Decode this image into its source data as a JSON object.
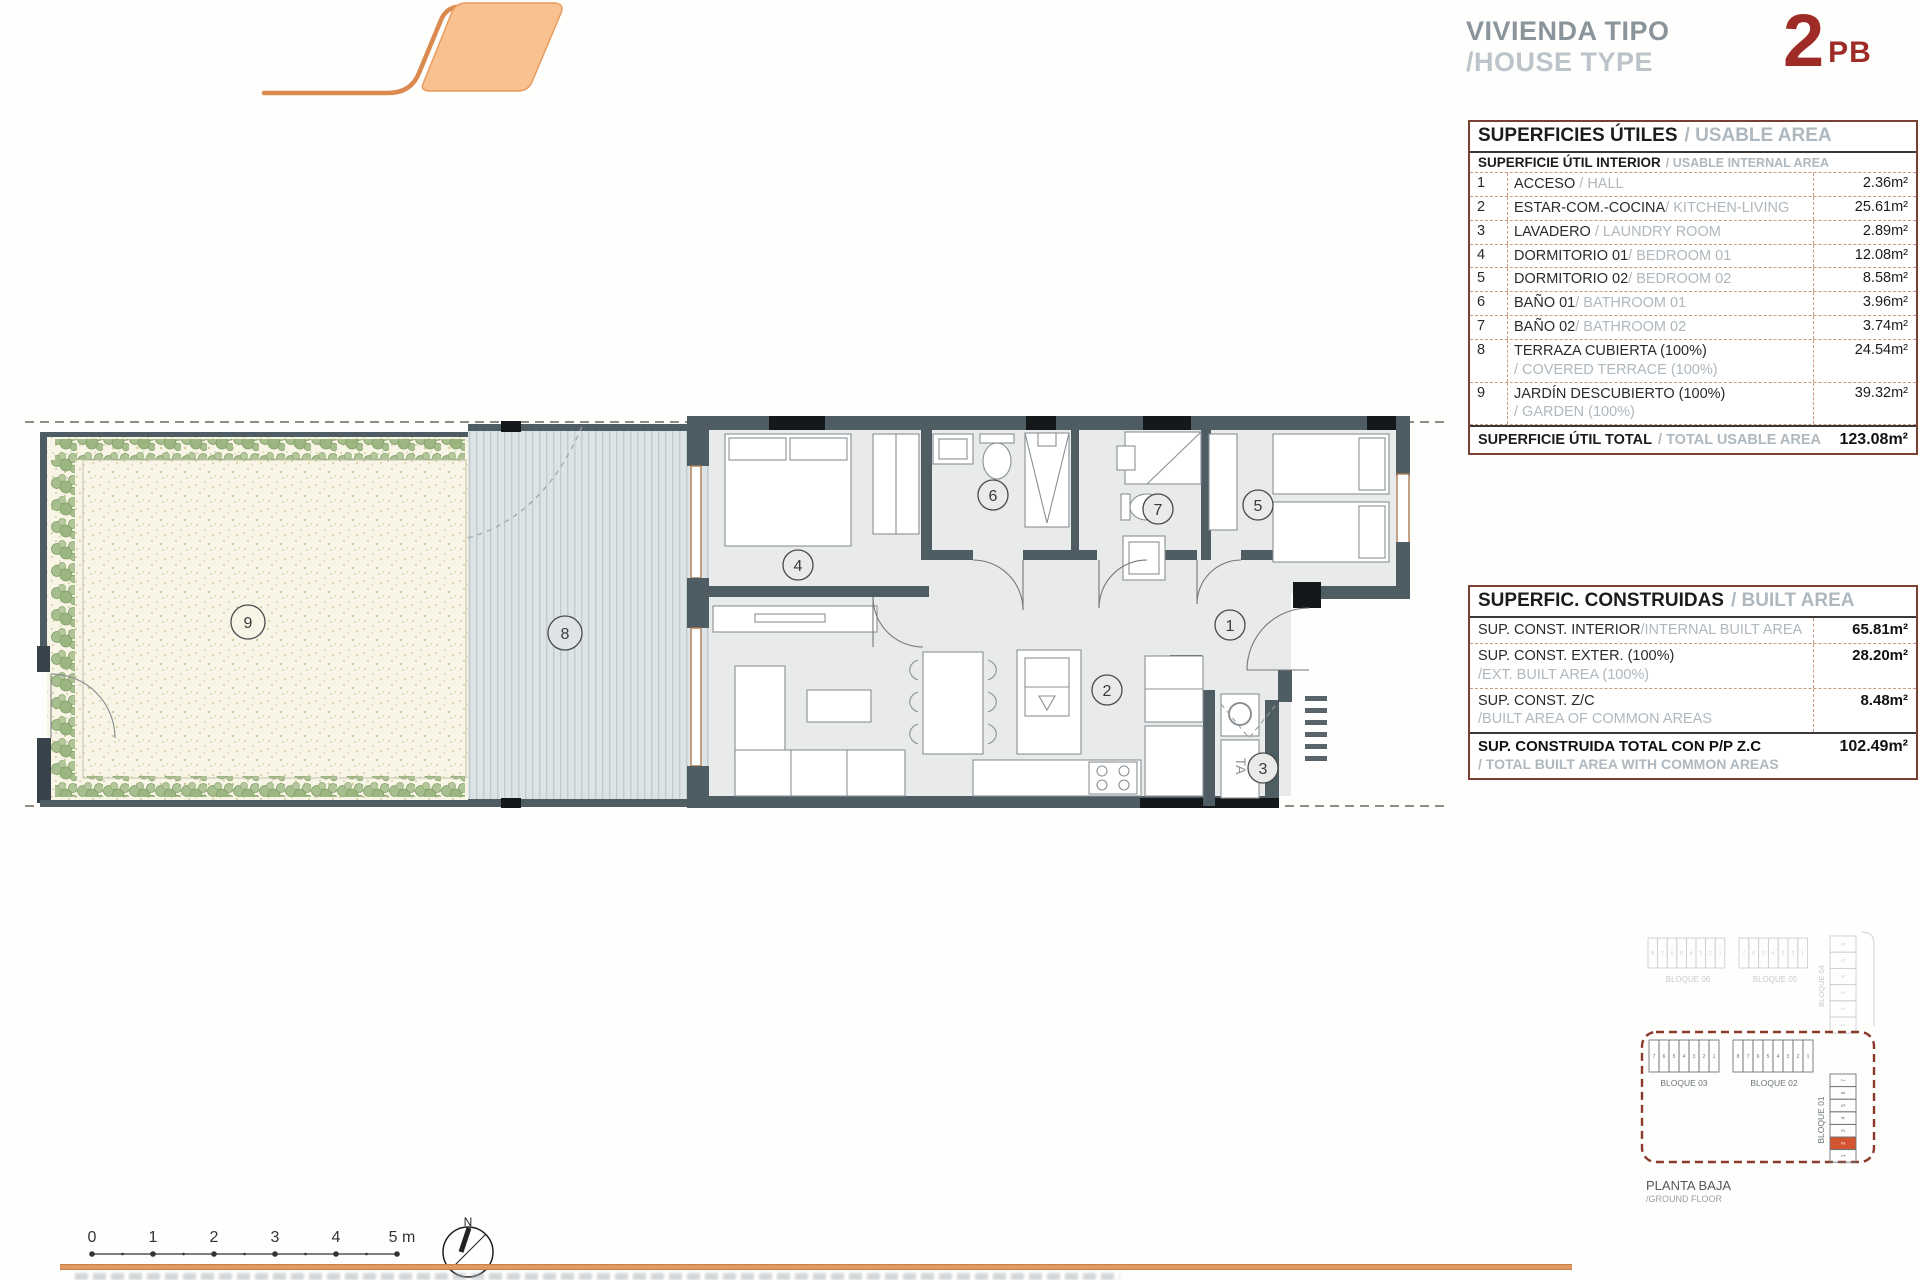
{
  "title": {
    "line1": "VIVIENDA TIPO",
    "line2": "/HOUSE TYPE",
    "type_number": "2",
    "type_suffix": "PB"
  },
  "usable_table": {
    "header_es": "SUPERFICIES ÚTILES",
    "header_en": "/ USABLE AREA",
    "subheader_es": "SUPERFICIE ÚTIL INTERIOR",
    "subheader_en": "/ USABLE INTERNAL AREA",
    "rows": [
      {
        "num": "1",
        "es": "ACCESO",
        "en": "/ HALL",
        "value": "2.36m²"
      },
      {
        "num": "2",
        "es": "ESTAR-COM.-COCINA",
        "en": "/ KITCHEN-LIVING",
        "value": "25.61m²"
      },
      {
        "num": "3",
        "es": "LAVADERO",
        "en": "/ LAUNDRY ROOM",
        "value": "2.89m²"
      },
      {
        "num": "4",
        "es": "DORMITORIO 01",
        "en": "/ BEDROOM 01",
        "value": "12.08m²"
      },
      {
        "num": "5",
        "es": "DORMITORIO 02",
        "en": "/ BEDROOM 02",
        "value": "8.58m²"
      },
      {
        "num": "6",
        "es": "BAÑO 01",
        "en": "/ BATHROOM 01",
        "value": "3.96m²"
      },
      {
        "num": "7",
        "es": "BAÑO 02",
        "en": "/ BATHROOM 02",
        "value": "3.74m²"
      },
      {
        "num": "8",
        "es": "TERRAZA CUBIERTA (100%)",
        "en": "/ COVERED TERRACE (100%)",
        "value": "24.54m²"
      },
      {
        "num": "9",
        "es": "JARDÍN DESCUBIERTO (100%)",
        "en": "/ GARDEN (100%)",
        "value": "39.32m²"
      }
    ],
    "total_es": "SUPERFICIE ÚTIL TOTAL",
    "total_en": "/ TOTAL USABLE AREA",
    "total_value": "123.08m²"
  },
  "built_table": {
    "header_es": "SUPERFIC. CONSTRUIDAS",
    "header_en": "/ BUILT AREA",
    "rows": [
      {
        "es": "SUP. CONST. INTERIOR",
        "en": "/INTERNAL BUILT AREA",
        "value": "65.81m²",
        "two_line": false
      },
      {
        "es": "SUP. CONST. EXTER. (100%)",
        "en": "/EXT. BUILT AREA (100%)",
        "value": "28.20m²",
        "two_line": true
      },
      {
        "es": "SUP. CONST. Z/C",
        "en": "/BUILT AREA OF COMMON AREAS",
        "value": "8.48m²",
        "two_line": true
      }
    ],
    "total_es": "SUP. CONSTRUIDA TOTAL CON P/P Z.C",
    "total_en": "/ TOTAL BUILT AREA WITH COMMON AREAS",
    "total_value": "102.49m²"
  },
  "plan": {
    "labels": {
      "hall": "1",
      "kitchen_living": "2",
      "laundry": "3",
      "bedroom01": "4",
      "bedroom02": "5",
      "bath01": "6",
      "bath02": "7",
      "terrace": "8",
      "garden": "9"
    },
    "ta_label": "TA"
  },
  "keyplan": {
    "faded_blocks": [
      {
        "label": "BLOQUE 06",
        "units": [
          "8",
          "7",
          "6",
          "5",
          "4",
          "3",
          "2",
          "1"
        ]
      },
      {
        "label": "BLOQUE 05",
        "units": [
          "7",
          "6",
          "5",
          "4",
          "3",
          "2",
          "1"
        ]
      },
      {
        "label": "BLOQUE 04",
        "units": [
          "6",
          "5",
          "4",
          "3",
          "2",
          "1"
        ]
      }
    ],
    "active_blocks": [
      {
        "label": "BLOQUE 03",
        "units": [
          "7",
          "6",
          "5",
          "4",
          "3",
          "2",
          "1"
        ]
      },
      {
        "label": "BLOQUE 02",
        "units": [
          "8",
          "7",
          "6",
          "5",
          "4",
          "3",
          "2",
          "1"
        ]
      },
      {
        "label": "BLOQUE 01",
        "units": [
          "7",
          "6",
          "5",
          "4",
          "3",
          "2",
          "1"
        ],
        "highlighted_unit": "2"
      }
    ],
    "floor_label": "PLANTA BAJA",
    "floor_label_en": "/GROUND FLOOR"
  },
  "scalebar": {
    "ticks": [
      "0",
      "1",
      "2",
      "3",
      "4",
      "5 m"
    ],
    "north": "N"
  },
  "colors": {
    "accent_orange": "#E89B5F",
    "logo_fill": "#F9C18F",
    "type_red": "#9E2B25",
    "table_border": "#7A4034",
    "dash": "#C89A7E",
    "wall": "#4E5C64",
    "highlight": "#D2552F"
  }
}
